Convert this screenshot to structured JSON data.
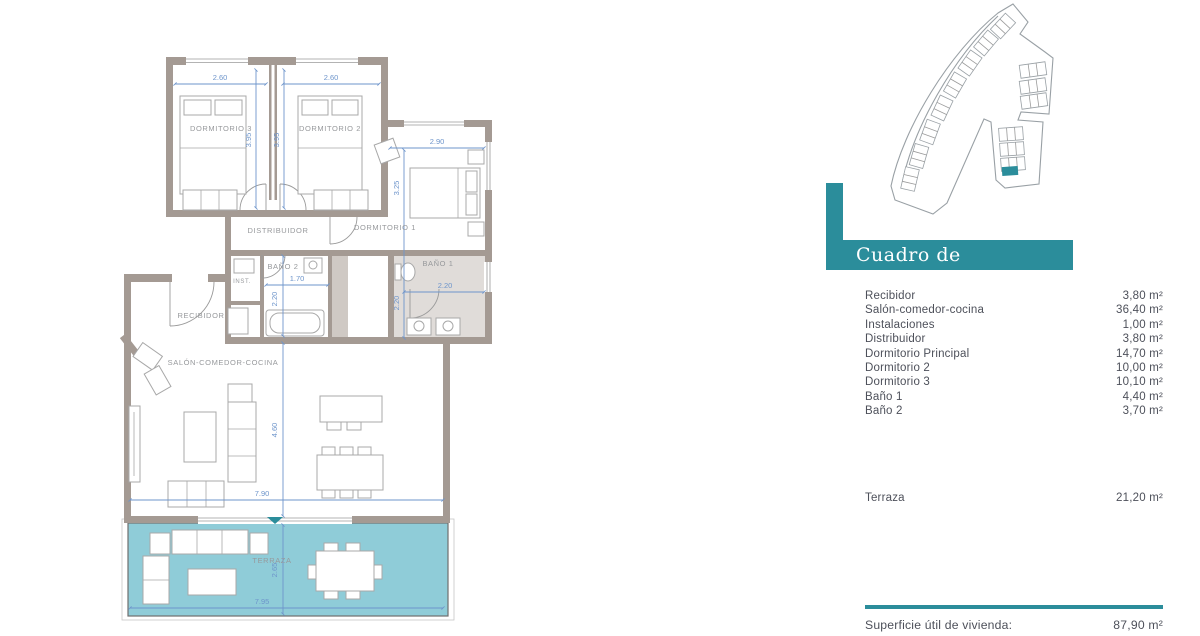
{
  "colors": {
    "accent_teal": "#2b8d9b",
    "terrace_fill": "#8fccd8",
    "wall_taupe": "#a49a93",
    "dimension_blue": "#6e95cb",
    "table_text": "#4d505a"
  },
  "plan": {
    "rooms": {
      "dormitorio3": "DORMITORIO 3",
      "dormitorio2": "DORMITORIO 2",
      "dormitorio1": "DORMITORIO 1",
      "distribuidor": "DISTRIBUIDOR",
      "bano2": "BAÑO 2",
      "bano1": "BAÑO 1",
      "inst": "INST.",
      "recibidor": "RECIBIDOR",
      "salon": "SALÓN-COMEDOR-COCINA",
      "terraza": "TERRAZA"
    },
    "dims": {
      "dorm3_width": "2.60",
      "dorm2_width": "2.60",
      "dorm3_height": "3.95",
      "dorm2_height": "3.95",
      "dorm1_width": "2.90",
      "dorm1_height": "3.25",
      "bano1_width": "2.20",
      "bano1_height": "2.20",
      "bano2_width": "1.70",
      "bano2_height": "2.20",
      "salon_width": "7.90",
      "salon_height": "4.60",
      "terraza_width": "7.95",
      "terraza_height": "2.65"
    }
  },
  "surfaces": {
    "title": "Cuadro de superficies",
    "rows": [
      {
        "label": "Recibidor",
        "value": "3,80 m²"
      },
      {
        "label": "Salón-comedor-cocina",
        "value": "36,40 m²"
      },
      {
        "label": "Instalaciones",
        "value": "1,00 m²"
      },
      {
        "label": "Distribuidor",
        "value": "3,80 m²"
      },
      {
        "label": "Dormitorio Principal",
        "value": "14,70 m²"
      },
      {
        "label": "Dormitorio 2",
        "value": "10,00 m²"
      },
      {
        "label": "Dormitorio 3",
        "value": "10,10 m²"
      },
      {
        "label": "Baño 1",
        "value": "4,40 m²"
      },
      {
        "label": "Baño 2",
        "value": "3,70 m²"
      }
    ],
    "terraza_row": {
      "label": "Terraza",
      "value": "21,20 m²"
    },
    "total": {
      "label": "Superficie útil de vivienda:",
      "value": "87,90 m²"
    }
  }
}
